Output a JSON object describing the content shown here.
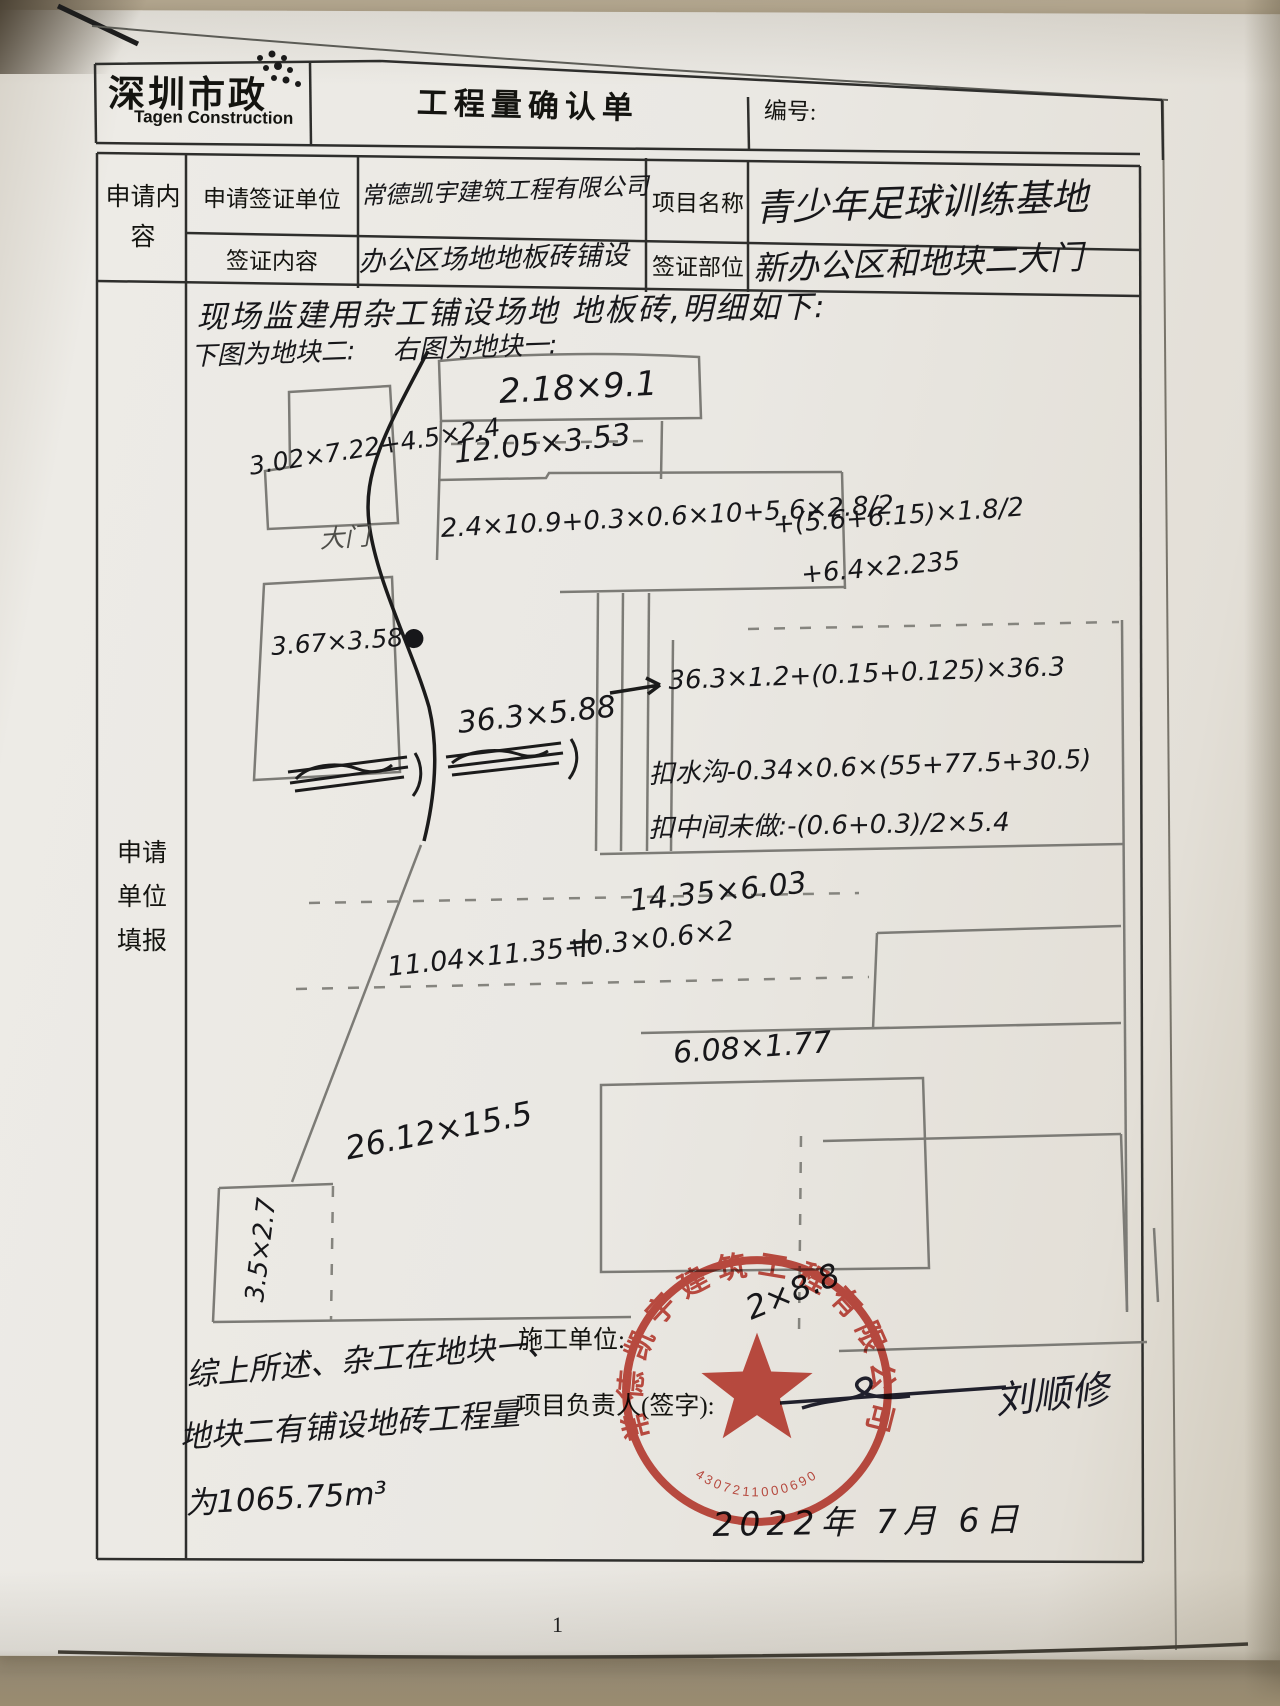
{
  "page": {
    "number": "1"
  },
  "header": {
    "logo_cn": "深圳市政",
    "logo_en": "Tagen Construction",
    "title": "工程量确认单",
    "number_label": "编号:"
  },
  "form": {
    "col_request": "申请内容",
    "col_fill": "申请单位填报",
    "row1": {
      "label1": "申请签证单位",
      "value1": "常德凯宇建筑工程有限公司",
      "label2": "项目名称",
      "value2": "青少年足球训练基地"
    },
    "row2": {
      "label1": "签证内容",
      "value1": "办公区场地地板砖铺设",
      "label2": "签证部位",
      "value2": "新办公区和地块二大门"
    }
  },
  "sketch": {
    "intro": "现场监建用杂工铺设场地 地板砖,明细如下:",
    "caption_below": "下图为地块二:",
    "caption_right": "右图为地块一:",
    "gate": "大门",
    "dims": {
      "d_top": "2.18×9.1",
      "d_row2": "12.05×3.53",
      "d_row3a": "2.4×10.9+0.3×0.6×10+5.6×2.8/2",
      "d_row3b": "+(5.6+6.15)×1.8/2",
      "d_row3c": "+6.4×2.235",
      "d_plot2a": "3.02×7.22+4.5×2.4",
      "d_plot2b": "3.67×3.58●",
      "d_strip": "36.3×5.88",
      "d_strip_side": "36.3×1.2+(0.15+0.125)×36.3",
      "d_ditch": "扣水沟-0.34×0.6×(55+77.5+30.5)",
      "d_middle": "扣中间未做:-(0.6+0.3)/2×5.4",
      "d_mid": "14.35×6.03",
      "d_mid2": "11.04×11.35+0.3×0.6×2",
      "d_small": "6.08×1.77",
      "d_big": "26.12×15.5",
      "d_corner": "3.5×2.7",
      "d_stamp": "2×8.8"
    }
  },
  "footer": {
    "summary1": "综上所述、杂工在地块一、",
    "summary2": "地块二有铺设地砖工程量",
    "summary3": "为1065.75m³",
    "unit_label": "施工单位:",
    "manager_label": "项目负责人(签字):",
    "signature": "刘顺修",
    "date": "2022年 7月 6日"
  },
  "stamp": {
    "company": "常德凯宇建筑工程有限公司",
    "serial": "4307211000690",
    "color": "#bf3526"
  }
}
